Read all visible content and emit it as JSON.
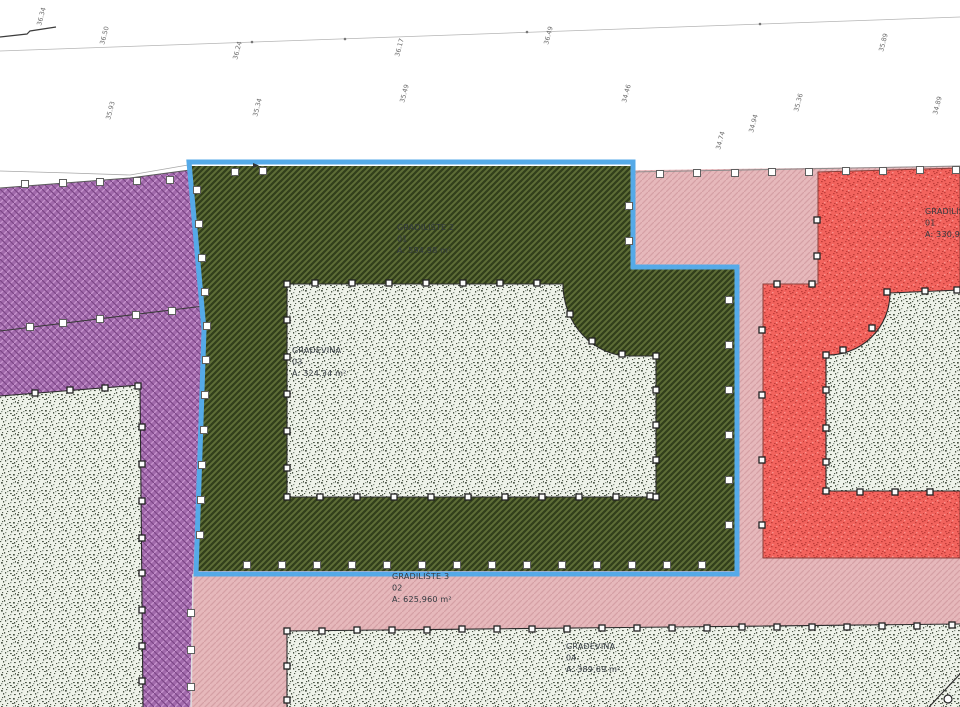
{
  "canvas": {
    "width": 960,
    "height": 707,
    "background": "#ffffff"
  },
  "colors": {
    "selection": "#55aae8",
    "purple_base": "#a169ab",
    "purple_light": "#c490cb",
    "purple_dark": "#7c4687",
    "green_base": "#5e6e37",
    "green_dark": "#323f1b",
    "pink_base": "#e6b8bb",
    "pink_line": "#d5a0a5",
    "red_base": "#f3635d",
    "red_speck": "#bf3d39",
    "red_speck_light": "#f8918d",
    "fp_base": "#eef2e9",
    "fp_speck": "#4d5748",
    "fp_speck_light": "#8d978a",
    "boundary": "#4f4f4f",
    "fp_boundary": "#2b2b2b",
    "label": "#333a40",
    "elev": "#6b6b6b"
  },
  "zones": [
    {
      "id": "zone-pink",
      "path": "M190,176 L960,166 L960,707 L190,707 Z",
      "pattern": "pink"
    },
    {
      "id": "zone-green-selected",
      "path": "M191,166 L631,166 L631,269 L735,269 L735,571 L197,571 L205,330 Z",
      "pattern": "green"
    },
    {
      "id": "zone-red",
      "path": "M763,558 L763,284 L818,284 L818,172 L960,168 L960,558 Z",
      "pattern": "red",
      "stroke": "#8a403c"
    },
    {
      "id": "zone-purple",
      "path": "M0,188 L130,178 L190,170 L205,330 L193,574 L191,707 L0,707 Z",
      "pattern": "purple"
    }
  ],
  "footprints": [
    {
      "id": "building-footprint-green",
      "path": "M287,284 L563,284 A67,72 0 0 0 630,356 L656,356 L656,497 L287,497 Z",
      "border": "M287,284 L563,284 A67,72 0 0 0 630,356 L656,356 L656,497 L287,497 Z"
    },
    {
      "id": "building-footprint-red",
      "path": "M826,491 L826,355 A62,62 0 0 0 890,293 L960,290 L960,491 Z",
      "border": "M960,491 L826,491 L826,355 A62,62 0 0 0 890,293 L960,290"
    },
    {
      "id": "building-footprint-pink",
      "path": "M287,631 L960,624 L960,707 L287,707 Z",
      "border": "M287,707 L287,631 L960,624"
    },
    {
      "id": "building-footprint-purple",
      "path": "M0,396 L140,385 L143,707 L0,707 Z",
      "border": "M0,396 L140,385 L143,707"
    }
  ],
  "selection": {
    "id": "selected-parcel-outline",
    "path": "M189,162 L633,162 L633,267 L737,267 L737,574 L196,574 L204,330 Z",
    "width": 5
  },
  "lines": [
    {
      "id": "contour-line",
      "path": "M0,51 L960,17",
      "color": "#b5b5b5",
      "w": 0.8,
      "layer": "under"
    },
    {
      "id": "survey-polyline",
      "path": "M0,37 L27,34 L30,31 L56,27",
      "color": "#3c3c3c",
      "w": 1.2,
      "layer": "under"
    },
    {
      "id": "terrain-edge-line",
      "path": "M0,171 L70,173 L130,175 L188,165",
      "color": "#a8a8a8",
      "w": 0.8,
      "layer": "under"
    },
    {
      "id": "purple-top-boundary",
      "path": "M0,188 L130,178 L190,170",
      "color": "#5a5a5a",
      "w": 1,
      "layer": "over"
    },
    {
      "id": "parcel-top-boundary",
      "path": "M633,172 L960,166",
      "color": "#8a8a8a",
      "w": 0.9,
      "layer": "over"
    },
    {
      "id": "purple-survey-line",
      "path": "M0,331 L204,306",
      "color": "#3a3a3a",
      "w": 1,
      "layer": "over"
    },
    {
      "id": "purple-pink-boundary",
      "path": "M193,574 L191,707",
      "color": "#e0dde0",
      "w": 1.5,
      "layer": "over"
    },
    {
      "id": "footpath-line",
      "path": "M929,707 L960,674",
      "color": "#2b2b2b",
      "w": 1.2,
      "layer": "top"
    }
  ],
  "markers": {
    "zone_squares": [
      [
        25,
        184
      ],
      [
        63,
        183
      ],
      [
        100,
        182
      ],
      [
        137,
        181
      ],
      [
        170,
        180
      ],
      [
        30,
        327
      ],
      [
        63,
        323
      ],
      [
        100,
        319
      ],
      [
        136,
        315
      ],
      [
        172,
        311
      ],
      [
        235,
        172
      ],
      [
        263,
        171
      ],
      [
        197,
        190
      ],
      [
        199,
        224
      ],
      [
        202,
        258
      ],
      [
        205,
        292
      ],
      [
        207,
        326
      ],
      [
        206,
        360
      ],
      [
        205,
        395
      ],
      [
        204,
        430
      ],
      [
        202,
        465
      ],
      [
        201,
        500
      ],
      [
        200,
        535
      ],
      [
        191,
        613
      ],
      [
        191,
        650
      ],
      [
        191,
        687
      ],
      [
        660,
        174
      ],
      [
        697,
        173
      ],
      [
        735,
        173
      ],
      [
        772,
        172
      ],
      [
        809,
        172
      ],
      [
        846,
        171
      ],
      [
        883,
        171
      ],
      [
        920,
        170
      ],
      [
        956,
        170
      ],
      [
        629,
        206
      ],
      [
        629,
        241
      ],
      [
        729,
        300
      ],
      [
        729,
        345
      ],
      [
        729,
        390
      ],
      [
        729,
        435
      ],
      [
        729,
        480
      ],
      [
        729,
        525
      ],
      [
        247,
        565
      ],
      [
        282,
        565
      ],
      [
        317,
        565
      ],
      [
        352,
        565
      ],
      [
        387,
        565
      ],
      [
        422,
        565
      ],
      [
        457,
        565
      ],
      [
        492,
        565
      ],
      [
        527,
        565
      ],
      [
        562,
        565
      ],
      [
        597,
        565
      ],
      [
        632,
        565
      ],
      [
        667,
        565
      ],
      [
        702,
        565
      ]
    ],
    "footprint_squares": [
      [
        287,
        284
      ],
      [
        315,
        283
      ],
      [
        352,
        283
      ],
      [
        389,
        283
      ],
      [
        426,
        283
      ],
      [
        463,
        283
      ],
      [
        500,
        283
      ],
      [
        537,
        283
      ],
      [
        570,
        314
      ],
      [
        592,
        341
      ],
      [
        622,
        354
      ],
      [
        656,
        356
      ],
      [
        656,
        390
      ],
      [
        656,
        425
      ],
      [
        656,
        460
      ],
      [
        656,
        497
      ],
      [
        650,
        496
      ],
      [
        616,
        497
      ],
      [
        579,
        497
      ],
      [
        542,
        497
      ],
      [
        505,
        497
      ],
      [
        468,
        497
      ],
      [
        431,
        497
      ],
      [
        394,
        497
      ],
      [
        357,
        497
      ],
      [
        320,
        497
      ],
      [
        287,
        497
      ],
      [
        287,
        320
      ],
      [
        287,
        357
      ],
      [
        287,
        394
      ],
      [
        287,
        431
      ],
      [
        287,
        468
      ],
      [
        826,
        355
      ],
      [
        843,
        350
      ],
      [
        872,
        328
      ],
      [
        887,
        292
      ],
      [
        925,
        291
      ],
      [
        957,
        290
      ],
      [
        826,
        390
      ],
      [
        826,
        428
      ],
      [
        826,
        462
      ],
      [
        826,
        491
      ],
      [
        860,
        492
      ],
      [
        895,
        492
      ],
      [
        930,
        492
      ],
      [
        287,
        631
      ],
      [
        322,
        631
      ],
      [
        357,
        630
      ],
      [
        392,
        630
      ],
      [
        427,
        630
      ],
      [
        462,
        629
      ],
      [
        497,
        629
      ],
      [
        532,
        629
      ],
      [
        567,
        629
      ],
      [
        602,
        628
      ],
      [
        637,
        628
      ],
      [
        672,
        628
      ],
      [
        707,
        628
      ],
      [
        742,
        627
      ],
      [
        777,
        627
      ],
      [
        812,
        627
      ],
      [
        847,
        627
      ],
      [
        882,
        626
      ],
      [
        917,
        626
      ],
      [
        952,
        625
      ],
      [
        287,
        666
      ],
      [
        287,
        700
      ],
      [
        35,
        393
      ],
      [
        70,
        390
      ],
      [
        105,
        388
      ],
      [
        138,
        386
      ],
      [
        142,
        427
      ],
      [
        142,
        464
      ],
      [
        142,
        501
      ],
      [
        142,
        538
      ],
      [
        142,
        573
      ],
      [
        142,
        610
      ],
      [
        142,
        646
      ],
      [
        142,
        681
      ],
      [
        777,
        284
      ],
      [
        812,
        284
      ],
      [
        817,
        220
      ],
      [
        817,
        256
      ],
      [
        762,
        330
      ],
      [
        762,
        395
      ],
      [
        762,
        460
      ],
      [
        762,
        525
      ]
    ],
    "circles": [
      [
        948,
        699
      ]
    ]
  },
  "flags": [
    [
      253,
      167
    ]
  ],
  "line_dots": [
    [
      252,
      42
    ],
    [
      345,
      39
    ],
    [
      527,
      32
    ],
    [
      760,
      24
    ]
  ],
  "zone_labels": [
    {
      "id": "label-gradiliste-2",
      "x": 397,
      "y": 230,
      "lines": [
        "GRADILIŠTE 2",
        "01",
        "A: 594,98 m²"
      ]
    },
    {
      "id": "label-gradjevina-03",
      "x": 292,
      "y": 353,
      "lines": [
        "GRAĐEVINA",
        "03",
        "A: 324,34 m²"
      ]
    },
    {
      "id": "label-gradiliste-3",
      "x": 392,
      "y": 579,
      "lines": [
        "GRADILIŠTE 3",
        "02",
        "A: 625,960 m²"
      ]
    },
    {
      "id": "label-gradjevina-04",
      "x": 566,
      "y": 649,
      "lines": [
        "GRAĐEVINA",
        "04",
        "A: 389,69 m²"
      ]
    },
    {
      "id": "label-gradiliste-4",
      "x": 925,
      "y": 214,
      "lines": [
        "GRADILIŠTE 4",
        "01",
        "A: 330,96 m²"
      ]
    }
  ],
  "elevation_labels": [
    {
      "x": 41,
      "y": 26,
      "text": "36.34"
    },
    {
      "x": 104,
      "y": 45,
      "text": "36.50"
    },
    {
      "x": 110,
      "y": 120,
      "text": "35.93"
    },
    {
      "x": 237,
      "y": 60,
      "text": "36.24"
    },
    {
      "x": 257,
      "y": 117,
      "text": "35.34"
    },
    {
      "x": 399,
      "y": 57,
      "text": "36.17"
    },
    {
      "x": 404,
      "y": 103,
      "text": "35.49"
    },
    {
      "x": 548,
      "y": 45,
      "text": "36.49"
    },
    {
      "x": 626,
      "y": 103,
      "text": "34.46"
    },
    {
      "x": 720,
      "y": 150,
      "text": "34.74"
    },
    {
      "x": 753,
      "y": 133,
      "text": "34.94"
    },
    {
      "x": 798,
      "y": 112,
      "text": "35.36"
    },
    {
      "x": 883,
      "y": 52,
      "text": "35.89"
    },
    {
      "x": 937,
      "y": 115,
      "text": "34.89"
    }
  ]
}
